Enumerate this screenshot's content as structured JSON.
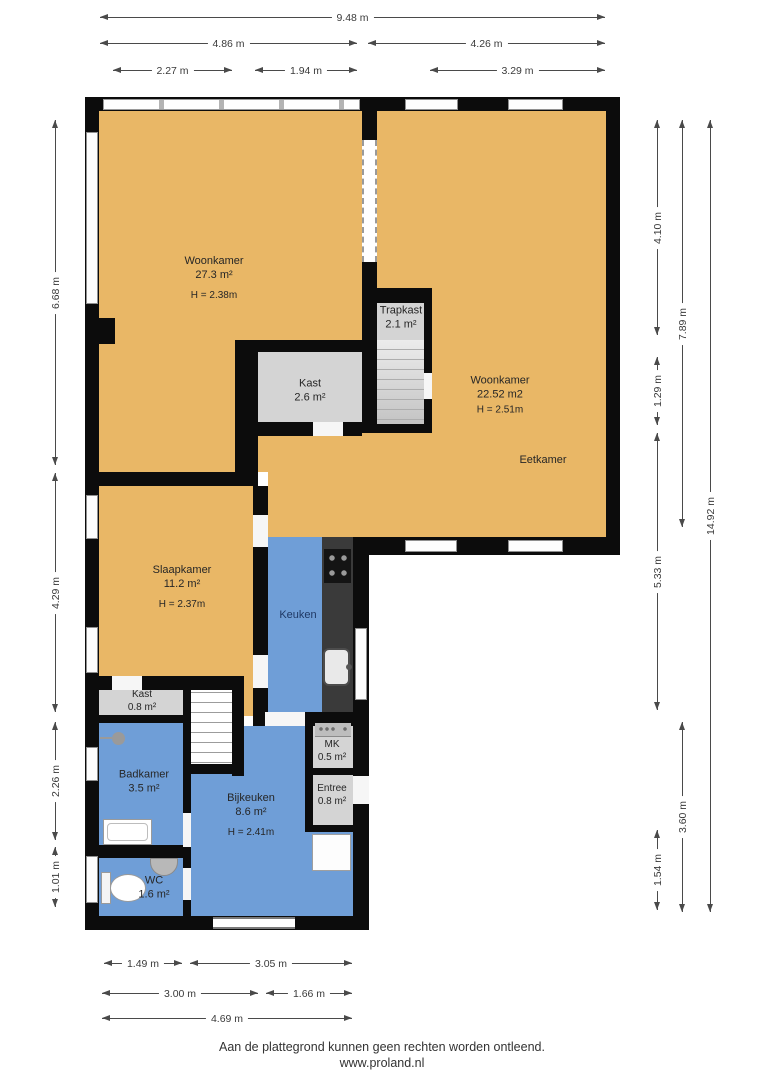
{
  "colors": {
    "floor_orange": "#e9b766",
    "floor_blue": "#6f9ed7",
    "room_gray": "#d4d4d4",
    "wall_black": "#0c0c0c",
    "counter_dark": "#3a3a3a"
  },
  "rooms": {
    "woonkamer_left": {
      "name": "Woonkamer",
      "area": "27.3 m²",
      "height": "H = 2.38m"
    },
    "woonkamer_right": {
      "name": "Woonkamer",
      "area": "22.52 m2",
      "height": "H = 2.51m"
    },
    "eetkamer": {
      "name": "Eetkamer"
    },
    "trapkast": {
      "name": "Trapkast",
      "area": "2.1 m²"
    },
    "kast_boven": {
      "name": "Kast",
      "area": "2.6 m²"
    },
    "slaapkamer": {
      "name": "Slaapkamer",
      "area": "11.2 m²",
      "height": "H = 2.37m"
    },
    "keuken": {
      "name": "Keuken"
    },
    "kast_beneden": {
      "name": "Kast",
      "area": "0.8 m²"
    },
    "badkamer": {
      "name": "Badkamer",
      "area": "3.5 m²"
    },
    "bijkeuken": {
      "name": "Bijkeuken",
      "area": "8.6 m²",
      "height": "H = 2.41m"
    },
    "mk": {
      "name": "MK",
      "area": "0.5 m²"
    },
    "entree": {
      "name": "Entree",
      "area": "0.8 m²"
    },
    "wc": {
      "name": "WC",
      "area": "1.6 m²"
    }
  },
  "dimensions": {
    "top": [
      "9.48 m",
      "4.86 m",
      "4.26 m",
      "2.27 m",
      "1.94 m",
      "3.29 m"
    ],
    "left": [
      "6.68 m",
      "4.29 m",
      "2.26 m",
      "1.01 m"
    ],
    "right": [
      "4.10 m",
      "1.29 m",
      "5.33 m",
      "1.54 m",
      "7.89 m",
      "3.60 m",
      "14.92 m"
    ],
    "bottom": [
      "1.49 m",
      "3.05 m",
      "3.00 m",
      "1.66 m",
      "4.69 m"
    ]
  },
  "footer": {
    "disclaimer": "Aan de plattegrond kunnen geen rechten worden ontleend.",
    "website": "www.proland.nl"
  }
}
